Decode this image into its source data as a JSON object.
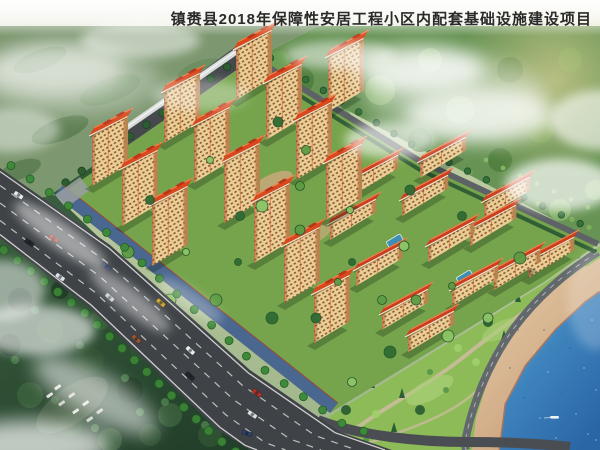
{
  "header": {
    "title": "镇赉县2018年保障性安居工程小区内配套基础设施建设项目"
  },
  "scene": {
    "features": [
      "high-rise residential towers with orange hip roofs",
      "six-storey residential blocks with red roofs",
      "perimeter commercial building with grey wall and light roof",
      "main avenue with traffic and street trees",
      "blue paved community plaza strip",
      "landscaped courtyards with trees",
      "park with winding paths",
      "coastal road",
      "sandy beach",
      "blue lake with small boat",
      "forest, farmland hills, drifting clouds and mist",
      "forest parking clearing with white cars"
    ],
    "colors": {
      "title_text": "#2a2a2a",
      "hills_green": "#7d9770",
      "forest_light": "#679354",
      "forest_dark": "#2c4a31",
      "park_green": "#8cbb57",
      "courtyard_green": "#76a44c",
      "facade_cream": "#ecce94",
      "facade_shade": "#b5854f",
      "roof_orange": "#d8491d",
      "roof_red": "#cc3f1e",
      "commercial_gray": "#45494c",
      "commercial_roof": "#d8dcda",
      "road_asphalt": "#3f4347",
      "lane_marking": "#e9e9e5",
      "plaza_blue": "#4a678f",
      "path_tan": "#c9bc9c",
      "sand": "#d9bb97",
      "sand_wet": "#a5664d",
      "water_deep": "#2e6dad",
      "water_shallow": "#6fc0d8",
      "tree_green": "#3f8a3a",
      "cloud_white": "#ffffff"
    }
  }
}
